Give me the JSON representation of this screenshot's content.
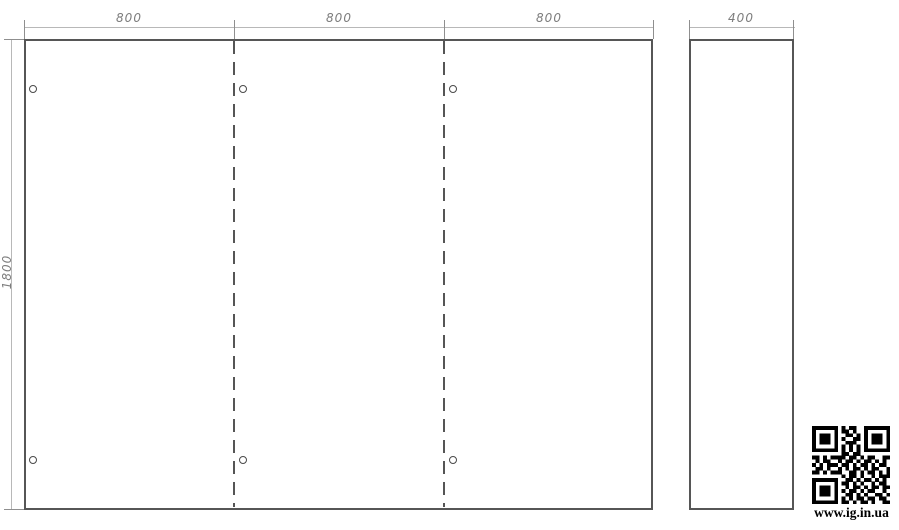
{
  "drawing": {
    "type": "technical-panel-drawing",
    "colors": {
      "object_line": "#565656",
      "dimension_line": "#b8b8b8",
      "dimension_text": "#7d7d7d",
      "qr": "#000000",
      "background": "#ffffff"
    },
    "dimensions": {
      "top_segments": [
        "800",
        "800",
        "800"
      ],
      "side_width": "400",
      "height": "1800"
    },
    "front_view": {
      "sections": 3,
      "fold_lines": 2,
      "holes": 6
    },
    "side_view": {
      "holes": 0
    }
  },
  "watermark": {
    "url": "www.ig.in.ua"
  },
  "qr": {
    "matrix": [
      "111111101011001111111",
      "100000101101001000001",
      "101110100110101011101",
      "101110101001101011101",
      "101110100111001011101",
      "100000101010101000001",
      "111111101010101111111",
      "000000001101100000000",
      "110101111011010110011",
      "010110010110101101010",
      "101011101101011010110",
      "011010010101101011001",
      "110101110011010110101",
      "000000001011010010111",
      "111111100110101101010",
      "100000101101010010110",
      "101110100101101011011",
      "101110101011010110010",
      "101110100110101001101",
      "100000101010110110110",
      "111111101101011010011"
    ]
  }
}
